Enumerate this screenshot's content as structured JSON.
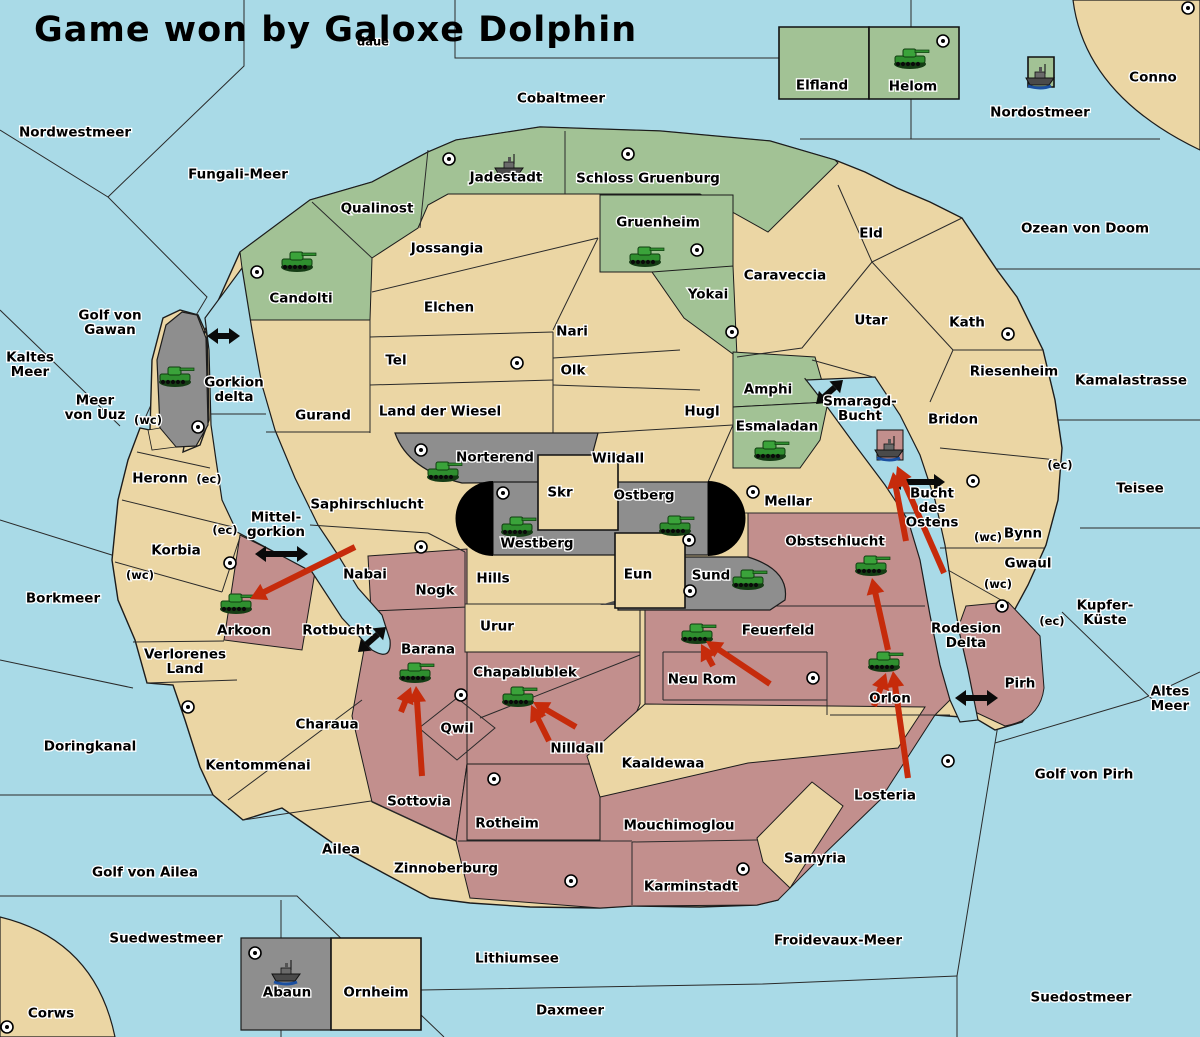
{
  "title": "Game won by Galoxe Dolphin",
  "colors": {
    "water": "#a9dae7",
    "land": "#ebd6a4",
    "green": "#a2c295",
    "gray": "#8e8e8e",
    "pink": "#c28f8d",
    "black": "#000000",
    "red_arrow": "#c62b0b",
    "black_arrow": "#0a0a0a",
    "border": "#1c1c1c"
  },
  "labels": [
    {
      "text": "daue",
      "x": 373,
      "y": 41,
      "size": "s"
    },
    {
      "text": "Nordwestmeer",
      "x": 75,
      "y": 132
    },
    {
      "text": "Fungali-Meer",
      "x": 238,
      "y": 174
    },
    {
      "text": "Cobaltmeer",
      "x": 561,
      "y": 98
    },
    {
      "text": "Nordostmeer",
      "x": 1040,
      "y": 112
    },
    {
      "text": "Conno",
      "x": 1153,
      "y": 77
    },
    {
      "text": "Ozean von Doom",
      "x": 1085,
      "y": 228
    },
    {
      "text": "Kamalastrasse",
      "x": 1131,
      "y": 380
    },
    {
      "text": "Teisee",
      "x": 1140,
      "y": 488
    },
    {
      "text": "Kupfer-Küste",
      "x": 1105,
      "y": 612,
      "lines": [
        "Kupfer-",
        "Küste"
      ]
    },
    {
      "text": "Altes Meer",
      "x": 1170,
      "y": 698,
      "lines": [
        "Altes",
        "Meer"
      ]
    },
    {
      "text": "Golf von Pirh",
      "x": 1084,
      "y": 774
    },
    {
      "text": "Froidevaux-Meer",
      "x": 838,
      "y": 940
    },
    {
      "text": "Suedostmeer",
      "x": 1081,
      "y": 997
    },
    {
      "text": "Daxmeer",
      "x": 570,
      "y": 1010
    },
    {
      "text": "Lithiumsee",
      "x": 517,
      "y": 958
    },
    {
      "text": "Suedwestmeer",
      "x": 166,
      "y": 938
    },
    {
      "text": "Corws",
      "x": 51,
      "y": 1013
    },
    {
      "text": "Golf von Ailea",
      "x": 145,
      "y": 872
    },
    {
      "text": "Doringkanal",
      "x": 90,
      "y": 746
    },
    {
      "text": "Borkmeer",
      "x": 63,
      "y": 598
    },
    {
      "text": "Kaltes Meer",
      "x": 30,
      "y": 364,
      "lines": [
        "Kaltes",
        "Meer"
      ]
    },
    {
      "text": "Meer von Uuz",
      "x": 95,
      "y": 407,
      "lines": [
        "Meer",
        "von Uuz"
      ]
    },
    {
      "text": "Golf von Gawan",
      "x": 110,
      "y": 322,
      "lines": [
        "Golf von",
        "Gawan"
      ]
    },
    {
      "text": "Gorkion delta",
      "x": 234,
      "y": 389,
      "lines": [
        "Gorkion",
        "delta"
      ]
    },
    {
      "text": "Mittelgorkion",
      "x": 276,
      "y": 524,
      "lines": [
        "Mittel-",
        "gorkion"
      ]
    },
    {
      "text": "Rotbucht",
      "x": 337,
      "y": 630
    },
    {
      "text": "Smaragd-Bucht",
      "x": 860,
      "y": 408,
      "lines": [
        "Smaragd-",
        "Bucht"
      ]
    },
    {
      "text": "Bucht des Ostens",
      "x": 932,
      "y": 507,
      "lines": [
        "Bucht",
        "des",
        "Ostens"
      ]
    },
    {
      "text": "Rodesion Delta",
      "x": 966,
      "y": 635,
      "lines": [
        "Rodesion",
        "Delta"
      ]
    },
    {
      "text": "Elfland",
      "x": 822,
      "y": 85
    },
    {
      "text": "Helom",
      "x": 913,
      "y": 86
    },
    {
      "text": "Jadestadt",
      "x": 506,
      "y": 177
    },
    {
      "text": "Schloss Gruenburg",
      "x": 648,
      "y": 178
    },
    {
      "text": "Qualinost",
      "x": 377,
      "y": 208
    },
    {
      "text": "Candolti",
      "x": 301,
      "y": 298
    },
    {
      "text": "Gruenheim",
      "x": 658,
      "y": 222
    },
    {
      "text": "Yokai",
      "x": 708,
      "y": 294
    },
    {
      "text": "Caraveccia",
      "x": 785,
      "y": 275
    },
    {
      "text": "Eld",
      "x": 871,
      "y": 233
    },
    {
      "text": "Utar",
      "x": 871,
      "y": 320
    },
    {
      "text": "Kath",
      "x": 967,
      "y": 322
    },
    {
      "text": "Riesenheim",
      "x": 1014,
      "y": 371
    },
    {
      "text": "Bridon",
      "x": 953,
      "y": 419
    },
    {
      "text": "Amphi",
      "x": 768,
      "y": 389
    },
    {
      "text": "Esmaladan",
      "x": 777,
      "y": 426
    },
    {
      "text": "Jossangia",
      "x": 447,
      "y": 248
    },
    {
      "text": "Elchen",
      "x": 449,
      "y": 307
    },
    {
      "text": "Nari",
      "x": 572,
      "y": 331
    },
    {
      "text": "Olk",
      "x": 573,
      "y": 370
    },
    {
      "text": "Tel",
      "x": 396,
      "y": 360
    },
    {
      "text": "Gurand",
      "x": 323,
      "y": 415
    },
    {
      "text": "Land der Wiesel",
      "x": 440,
      "y": 411
    },
    {
      "text": "Hugl",
      "x": 702,
      "y": 411
    },
    {
      "text": "Wildall",
      "x": 618,
      "y": 458
    },
    {
      "text": "Norterend",
      "x": 495,
      "y": 457
    },
    {
      "text": "Skr",
      "x": 560,
      "y": 492
    },
    {
      "text": "Ostberg",
      "x": 644,
      "y": 495
    },
    {
      "text": "Westberg",
      "x": 537,
      "y": 543
    },
    {
      "text": "Eun",
      "x": 638,
      "y": 574
    },
    {
      "text": "Sund",
      "x": 711,
      "y": 575
    },
    {
      "text": "Mellar",
      "x": 788,
      "y": 501
    },
    {
      "text": "Saphirschlucht",
      "x": 367,
      "y": 504
    },
    {
      "text": "Nabai",
      "x": 365,
      "y": 574
    },
    {
      "text": "Hills",
      "x": 493,
      "y": 578
    },
    {
      "text": "Nogk",
      "x": 435,
      "y": 590
    },
    {
      "text": "Urur",
      "x": 497,
      "y": 626
    },
    {
      "text": "Heronn",
      "x": 160,
      "y": 478
    },
    {
      "text": "Korbia",
      "x": 176,
      "y": 550
    },
    {
      "text": "Arkoon",
      "x": 244,
      "y": 630
    },
    {
      "text": "Verlorenes Land",
      "x": 185,
      "y": 661,
      "lines": [
        "Verlorenes",
        "Land"
      ]
    },
    {
      "text": "Kentommenai",
      "x": 258,
      "y": 765
    },
    {
      "text": "Charaua",
      "x": 327,
      "y": 724
    },
    {
      "text": "Ailea",
      "x": 341,
      "y": 849
    },
    {
      "text": "Barana",
      "x": 428,
      "y": 649
    },
    {
      "text": "Sottovia",
      "x": 419,
      "y": 801
    },
    {
      "text": "Qwil",
      "x": 457,
      "y": 728
    },
    {
      "text": "Chapablublek",
      "x": 525,
      "y": 672
    },
    {
      "text": "Nilldall",
      "x": 577,
      "y": 748
    },
    {
      "text": "Kaaldewaa",
      "x": 663,
      "y": 763
    },
    {
      "text": "Neu Rom",
      "x": 702,
      "y": 679
    },
    {
      "text": "Feuerfeld",
      "x": 778,
      "y": 630
    },
    {
      "text": "Obstschlucht",
      "x": 835,
      "y": 541
    },
    {
      "text": "Orlon",
      "x": 890,
      "y": 698
    },
    {
      "text": "Losteria",
      "x": 885,
      "y": 795
    },
    {
      "text": "Rotheim",
      "x": 507,
      "y": 823
    },
    {
      "text": "Zinnoberburg",
      "x": 446,
      "y": 868
    },
    {
      "text": "Mouchimoglou",
      "x": 679,
      "y": 825
    },
    {
      "text": "Karminstadt",
      "x": 691,
      "y": 886
    },
    {
      "text": "Samyria",
      "x": 815,
      "y": 858
    },
    {
      "text": "Pirh",
      "x": 1020,
      "y": 683
    },
    {
      "text": "Bynn",
      "x": 1023,
      "y": 533
    },
    {
      "text": "Gwaul",
      "x": 1028,
      "y": 563
    },
    {
      "text": "Abaun",
      "x": 287,
      "y": 992
    },
    {
      "text": "Ornheim",
      "x": 376,
      "y": 992
    }
  ],
  "coast_tags": [
    {
      "text": "(wc)",
      "x": 148,
      "y": 420
    },
    {
      "text": "(wc)",
      "x": 140,
      "y": 575
    },
    {
      "text": "(wc)",
      "x": 988,
      "y": 537
    },
    {
      "text": "(wc)",
      "x": 998,
      "y": 584
    },
    {
      "text": "(ec)",
      "x": 209,
      "y": 479
    },
    {
      "text": "(ec)",
      "x": 225,
      "y": 530
    },
    {
      "text": "(ec)",
      "x": 1060,
      "y": 465
    },
    {
      "text": "(ec)",
      "x": 1052,
      "y": 621
    }
  ],
  "supply_centers": [
    [
      943,
      41
    ],
    [
      1188,
      8
    ],
    [
      449,
      159
    ],
    [
      628,
      154
    ],
    [
      257,
      272
    ],
    [
      697,
      250
    ],
    [
      732,
      332
    ],
    [
      517,
      363
    ],
    [
      1008,
      334
    ],
    [
      198,
      427
    ],
    [
      421,
      450
    ],
    [
      503,
      493
    ],
    [
      753,
      492
    ],
    [
      689,
      540
    ],
    [
      690,
      591
    ],
    [
      421,
      547
    ],
    [
      230,
      563
    ],
    [
      461,
      695
    ],
    [
      813,
      678
    ],
    [
      973,
      481
    ],
    [
      1002,
      606
    ],
    [
      948,
      761
    ],
    [
      494,
      779
    ],
    [
      571,
      881
    ],
    [
      743,
      869
    ],
    [
      188,
      707
    ],
    [
      255,
      953
    ],
    [
      7,
      1027
    ]
  ],
  "tanks": [
    [
      910,
      57
    ],
    [
      297,
      260
    ],
    [
      645,
      255
    ],
    [
      175,
      375
    ],
    [
      770,
      449
    ],
    [
      443,
      470
    ],
    [
      517,
      525
    ],
    [
      675,
      524
    ],
    [
      748,
      578
    ],
    [
      236,
      602
    ],
    [
      415,
      671
    ],
    [
      518,
      695
    ],
    [
      697,
      632
    ],
    [
      871,
      564
    ],
    [
      884,
      660
    ]
  ],
  "ships": [
    {
      "x": 510,
      "y": 166,
      "flag": null
    },
    {
      "x": 1041,
      "y": 76,
      "flag": "green"
    },
    {
      "x": 890,
      "y": 448,
      "flag": "pink"
    },
    {
      "x": 287,
      "y": 972,
      "flag": null
    }
  ],
  "red_arrows": [
    [
      355,
      547,
      250,
      599
    ],
    [
      770,
      684,
      706,
      641
    ],
    [
      713,
      666,
      701,
      644
    ],
    [
      576,
      727,
      533,
      702
    ],
    [
      549,
      741,
      531,
      705
    ],
    [
      422,
      776,
      416,
      686
    ],
    [
      401,
      712,
      411,
      687
    ],
    [
      908,
      778,
      893,
      671
    ],
    [
      874,
      706,
      886,
      673
    ],
    [
      888,
      650,
      872,
      578
    ],
    [
      944,
      573,
      897,
      466
    ],
    [
      906,
      541,
      893,
      472
    ]
  ],
  "black_arrows": [
    [
      207,
      336,
      240,
      336
    ],
    [
      255,
      554,
      308,
      554
    ],
    [
      358,
      652,
      386,
      627
    ],
    [
      816,
      404,
      843,
      380
    ],
    [
      890,
      482,
      945,
      482
    ],
    [
      955,
      698,
      998,
      698
    ]
  ]
}
